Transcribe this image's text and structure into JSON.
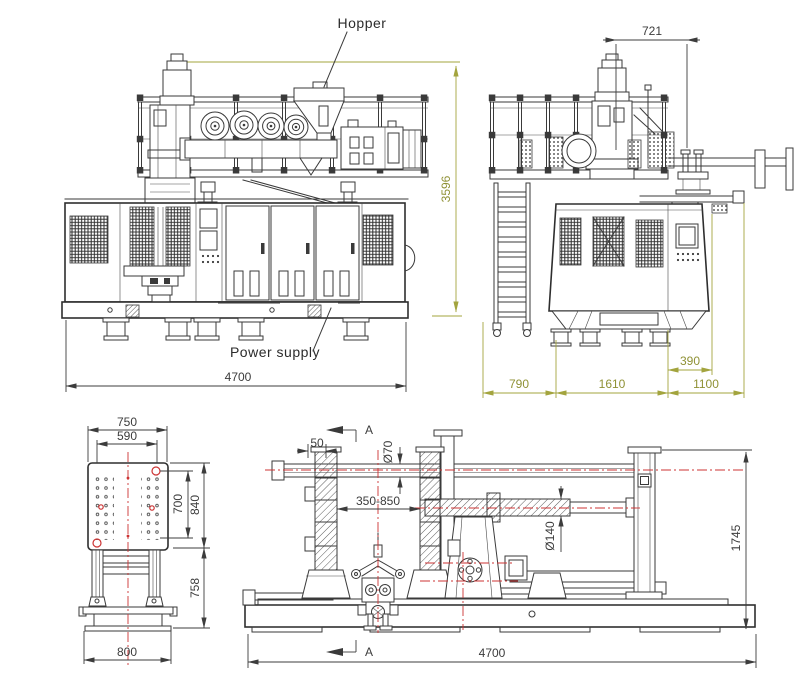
{
  "drawing": {
    "labels": {
      "hopper": "Hopper",
      "power_supply": "Power supply",
      "section": "A"
    },
    "front": {
      "width": "4700",
      "height": "3596"
    },
    "side": {
      "top": "721",
      "offset": "390",
      "left": "790",
      "middle": "1610",
      "right": "1100"
    },
    "platen": {
      "outer_width": "750",
      "inner_width": "590",
      "inner_height": "700",
      "outer_height": "840",
      "leg_height": "758",
      "base_width": "800"
    },
    "section": {
      "gap": "50",
      "rod_dia": "Ø70",
      "stroke": "350-850",
      "screw_dia": "Ø140",
      "height": "1745",
      "width": "4700"
    },
    "colors": {
      "line": "#3a3a3a",
      "dimension_accent": "#a3a43e",
      "centerline_red": "#cc3333"
    }
  }
}
